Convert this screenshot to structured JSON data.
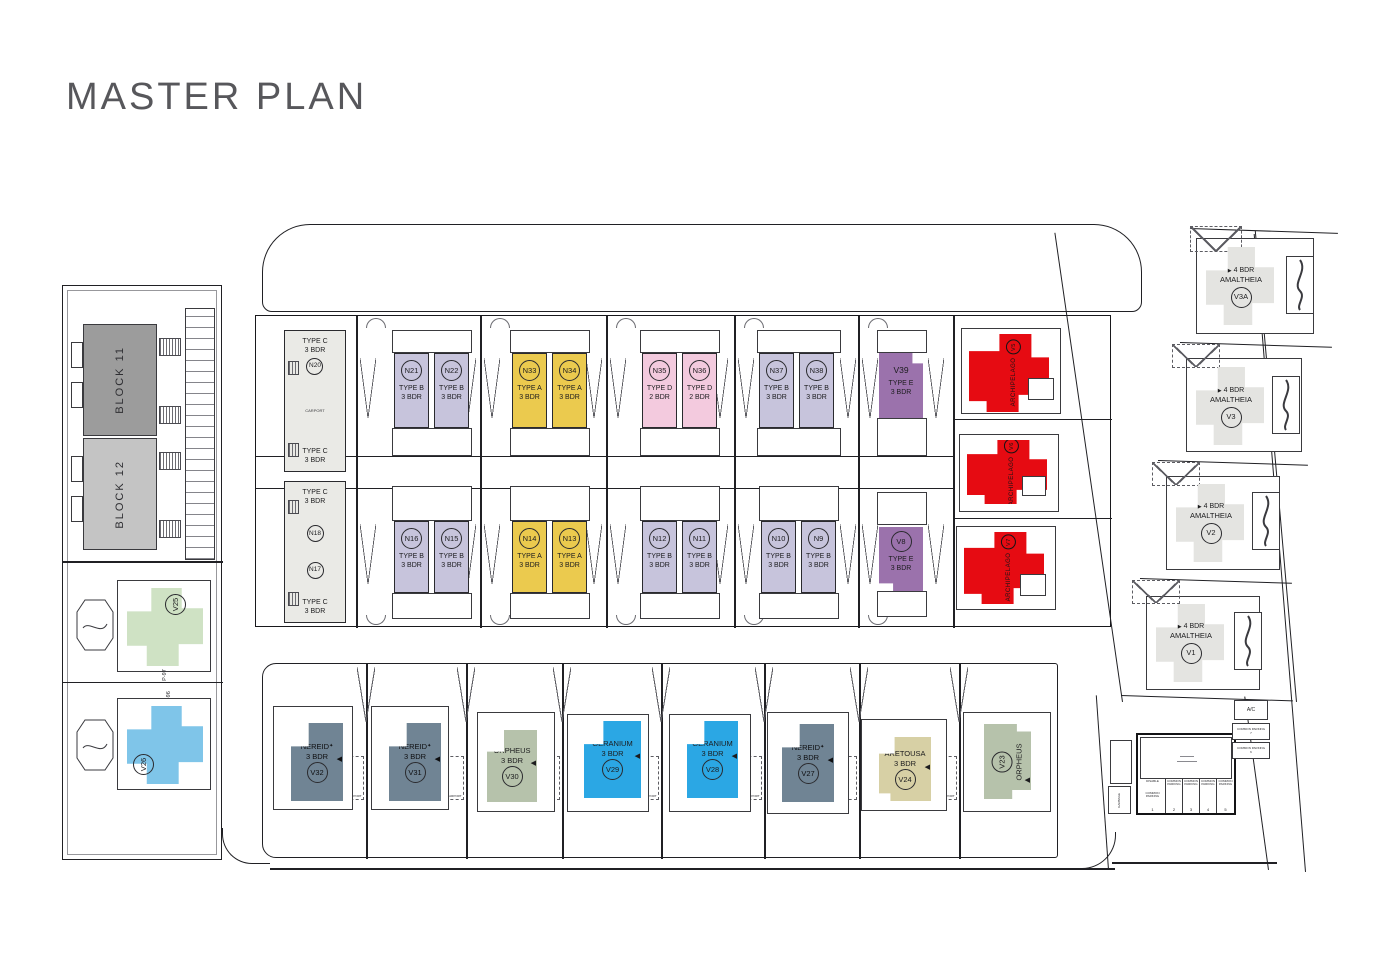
{
  "title": "MASTER PLAN",
  "colors": {
    "type_a": "#ebca4e",
    "type_b": "#c7c4dc",
    "type_c": "#eaeae6",
    "type_d": "#f3cade",
    "type_e": "#9b72ac",
    "archipelago": "#e60b12",
    "nereid": "#70listed8494",
    "orpheus": "#b6c2ab",
    "geranium": "#2ba7e4",
    "aretousa": "#d7d0a5",
    "v25": "#cfe2c4",
    "v26": "#7fc5e9",
    "amaltheia": "#e4e4e1",
    "block11": "#9c9c9c",
    "block12": "#c4c4c4"
  },
  "icons": {
    "entry_marker": "◀",
    "flag_marker": "▶",
    "nereid_star": "✦"
  },
  "labels": {
    "carport": "CARPORT"
  },
  "west": {
    "blocks": [
      {
        "label": "BLOCK 11"
      },
      {
        "label": "BLOCK 12"
      }
    ],
    "villas": [
      {
        "id": "V25"
      },
      {
        "id": "V26"
      }
    ],
    "parking": [
      "P-97",
      "P-96"
    ]
  },
  "main": {
    "top": [
      {
        "id": "N20",
        "type": "TYPE C",
        "bdr": "3 BDR"
      },
      {
        "type": "TYPE C",
        "bdr": "3 BDR"
      },
      {
        "id": "N21",
        "type": "TYPE B",
        "bdr": "3 BDR"
      },
      {
        "id": "N22",
        "type": "TYPE B",
        "bdr": "3 BDR"
      },
      {
        "id": "N33",
        "type": "TYPE A",
        "bdr": "3 BDR"
      },
      {
        "id": "N34",
        "type": "TYPE A",
        "bdr": "3 BDR"
      },
      {
        "id": "N35",
        "type": "TYPE D",
        "bdr": "2 BDR"
      },
      {
        "id": "N36",
        "type": "TYPE D",
        "bdr": "2 BDR"
      },
      {
        "id": "N37",
        "type": "TYPE B",
        "bdr": "3 BDR"
      },
      {
        "id": "N38",
        "type": "TYPE B",
        "bdr": "3 BDR"
      },
      {
        "id": "V39",
        "type": "TYPE E",
        "bdr": "3 BDR"
      }
    ],
    "bottom": [
      {
        "id": "N18",
        "type": "TYPE C",
        "bdr": "3 BDR"
      },
      {
        "id": "N17",
        "type": "TYPE C",
        "bdr": "3 BDR"
      },
      {
        "id": "N16",
        "type": "TYPE B",
        "bdr": "3 BDR"
      },
      {
        "id": "N15",
        "type": "TYPE B",
        "bdr": "3 BDR"
      },
      {
        "id": "N14",
        "type": "TYPE A",
        "bdr": "3 BDR"
      },
      {
        "id": "N13",
        "type": "TYPE A",
        "bdr": "3 BDR"
      },
      {
        "id": "N12",
        "type": "TYPE B",
        "bdr": "3 BDR"
      },
      {
        "id": "N11",
        "type": "TYPE B",
        "bdr": "3 BDR"
      },
      {
        "id": "N10",
        "type": "TYPE B",
        "bdr": "3 BDR"
      },
      {
        "id": "N9",
        "type": "TYPE B",
        "bdr": "3 BDR"
      },
      {
        "id": "V8",
        "type": "TYPE E",
        "bdr": "3 BDR"
      }
    ],
    "archipelago": [
      {
        "id": "V5",
        "name": "ARCHIPELAGO"
      },
      {
        "id": "V6",
        "name": "ARCHIPELAGO"
      },
      {
        "id": "V7",
        "name": "ARCHIPELAGO"
      }
    ]
  },
  "south": [
    {
      "id": "V32",
      "name": "NEREID",
      "marker": "✦",
      "bdr": "3 BDR"
    },
    {
      "id": "V31",
      "name": "NEREID",
      "marker": "✦",
      "bdr": "3 BDR"
    },
    {
      "id": "V30",
      "name": "ORPHEUS",
      "marker": "",
      "bdr": "3 BDR"
    },
    {
      "id": "V29",
      "name": "GERANIUM",
      "marker": "",
      "bdr": "3 BDR"
    },
    {
      "id": "V28",
      "name": "GERANIUM",
      "marker": "",
      "bdr": "3 BDR"
    },
    {
      "id": "V27",
      "name": "NEREID",
      "marker": "✦",
      "bdr": "3 BDR"
    },
    {
      "id": "V24",
      "name": "ARETOUSA",
      "marker": "",
      "bdr": "3 BDR"
    },
    {
      "id": "V23",
      "name": "ORPHEUS",
      "marker": "",
      "bdr": ""
    }
  ],
  "east": [
    {
      "id": "V3A",
      "name": "AMALTHEIA",
      "bdr": "4 BDR"
    },
    {
      "id": "V3",
      "name": "AMALTHEIA",
      "bdr": "4 BDR"
    },
    {
      "id": "V2",
      "name": "AMALTHEIA",
      "bdr": "4 BDR"
    },
    {
      "id": "V1",
      "name": "AMALTHEIA",
      "bdr": "4 BDR"
    }
  ],
  "common": {
    "ac": "A/C",
    "garbage": "GARBAGE",
    "row": [
      {
        "top": "DISABLE",
        "label": "COMMON PARKING",
        "num": "1"
      },
      {
        "top": "",
        "label": "COMMON PARKING",
        "num": "2"
      },
      {
        "top": "",
        "label": "COMMON PARKING",
        "num": "3"
      },
      {
        "top": "",
        "label": "COMMON PARKING",
        "num": "4"
      },
      {
        "top": "",
        "label": "COMMON PARKING",
        "num": "5"
      }
    ],
    "side": [
      {
        "label": "COMMON PARKING",
        "num": "7"
      },
      {
        "label": "COMMON PARKING",
        "num": "6"
      }
    ]
  }
}
